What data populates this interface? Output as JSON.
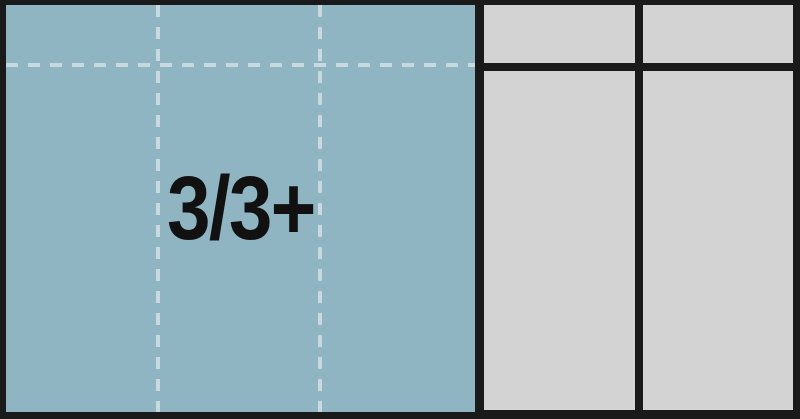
{
  "diagram": {
    "label": "3/3+",
    "colors": {
      "background": "#1a1a1a",
      "tray_fill": "#8fb4c2",
      "compartment_fill": "#d3d3d3",
      "dashed_line": "#c8dae0",
      "label_text": "#111111"
    }
  }
}
